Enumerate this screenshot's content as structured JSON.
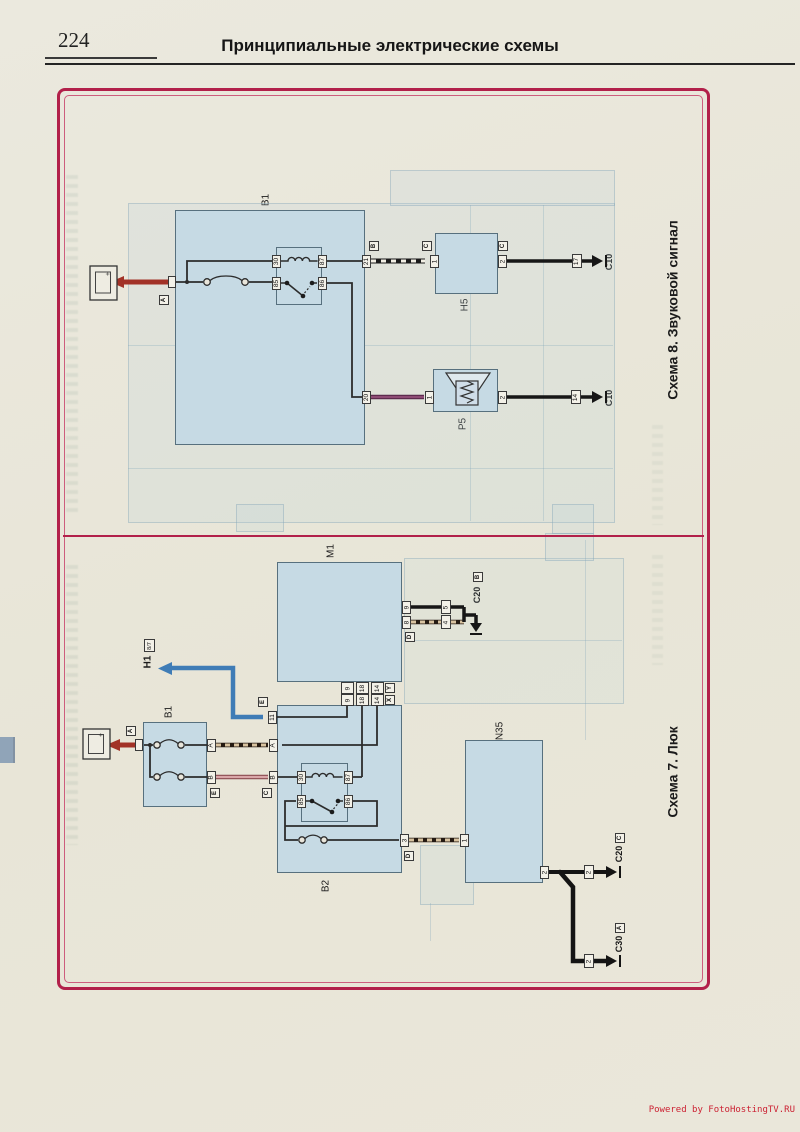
{
  "page": {
    "number": "224",
    "title": "Принципиальные электрические схемы",
    "watermark": "Powered by FotoHostingTV.RU"
  },
  "colors": {
    "frame": "#b2204a",
    "box_fill": "#c6dae4",
    "wire_red": "#a23227",
    "wire_blue": "#3f7cb6",
    "wire_purple": "#5e2b4e",
    "wire_pink": "#8a4a50",
    "wire_black": "#161616",
    "paper": "#e9e6db",
    "watermark_red": "#cc2233"
  },
  "glyphs": {
    "plus": "+"
  },
  "scheme8": {
    "title": "Схема 8. Звуковой сигнал",
    "b1": "B1",
    "r3": "R3",
    "h5": "H5",
    "p5": "P5",
    "f10_name": "F10",
    "f10_rating": "15A",
    "t30": "30",
    "t87": "87",
    "t85": "85",
    "t86": "86",
    "t21": "21",
    "t20": "20",
    "h5_t1": "1",
    "h5_t2": "2",
    "conn17": "17",
    "conn14": "14",
    "gnd_top": "C10",
    "gnd_bottom": "C10",
    "lbl_a": "A",
    "lbl_b": "B",
    "lbl_c1": "C",
    "lbl_c2": "C"
  },
  "scheme7": {
    "title": "Схема 7. Люк",
    "m1": "M1",
    "b1": "B1",
    "b2": "B2",
    "r13": "R13",
    "n35": "N35",
    "h1": "H1",
    "h1_ref": "8/7",
    "f53_name": "F53",
    "f53_rating": "10A",
    "f37_name": "F37",
    "f37_rating": "10A",
    "f46_name": "F46",
    "f46_rating": "15A",
    "m1_t9": "9",
    "m1_t8": "8",
    "conn5": "5",
    "conn4": "4",
    "y9": "9",
    "y18": "18",
    "y14": "14",
    "x9": "9",
    "x18": "18",
    "x14": "14",
    "lbl_y": "Y",
    "lbl_x": "X",
    "t11": "11",
    "r13_t30": "30",
    "r13_t87": "87",
    "r13_t85": "85",
    "r13_t86": "86",
    "t3": "3",
    "n35_t1": "1",
    "n35_t2": "2",
    "conn2_top": "2",
    "conn2_bottom": "2",
    "b1_ta": "A",
    "b1_tb": "B",
    "b2_ta": "A",
    "b2_tb": "B",
    "gnd_m1": "C20",
    "gnd_n35": "C20",
    "gnd_c30": "C30",
    "lbl_a": "A",
    "lbl_e_b1": "E",
    "lbl_c_b2": "C",
    "lbl_e_t11": "E",
    "lbl_d_m1": "D",
    "lbl_d_t3": "D",
    "lbl_b_c20": "B",
    "lbl_c_c20": "C",
    "lbl_a_c30": "A"
  }
}
